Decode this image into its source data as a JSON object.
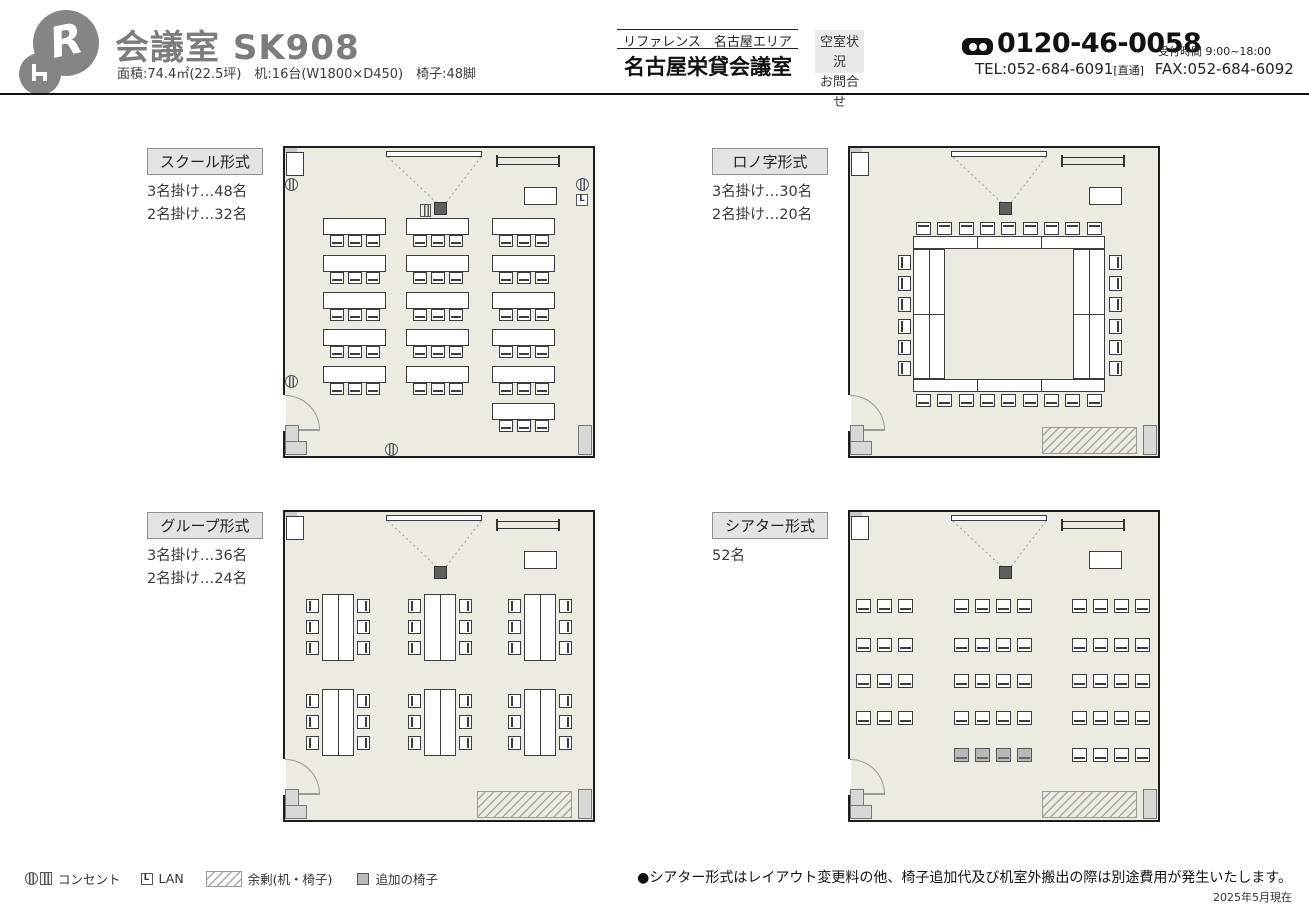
{
  "header": {
    "title": "会議室 SK908",
    "specs": "面積:74.4㎡(22.5坪)　机:16台(W1800×D450)　椅子:48脚",
    "area_line": "リファレンス　名古屋エリア",
    "venue_name": "名古屋栄貸会議室",
    "availability": [
      "空室状況",
      "お問合せ"
    ],
    "freedial": "0120-46-0058",
    "hours": "受付時間 9:00~18:00",
    "tel": "TEL:052-684-6091",
    "tel_note": "[直通]",
    "fax": "FAX:052-684-6092"
  },
  "layouts": [
    {
      "id": "school",
      "label": "スクール形式",
      "capacity": [
        "3名掛け…48名",
        "2名掛け…32名"
      ]
    },
    {
      "id": "rono",
      "label": "ロノ字形式",
      "capacity": [
        "3名掛け…30名",
        "2名掛け…20名"
      ]
    },
    {
      "id": "group",
      "label": "グループ形式",
      "capacity": [
        "3名掛け…36名",
        "2名掛け…24名"
      ]
    },
    {
      "id": "theater",
      "label": "シアター形式",
      "capacity": [
        "52名"
      ]
    }
  ],
  "legend": {
    "outlet": "コンセント",
    "lan_letter": "L",
    "lan": "LAN",
    "surplus": "余剰(机・椅子)",
    "extra_chair": "追加の椅子"
  },
  "footnote": "●シアター形式はレイアウト変更料の他、椅子追加代及び机室外搬出の際は別途費用が発生いたします。",
  "as_of": "2025年5月現在",
  "colors": {
    "room_bg": "#edeae1",
    "wall": "#1d1d1d",
    "surplus_hatch": "#a8a8a8",
    "extra_chair_fill": "#b9b9b9",
    "title_gray": "#7c7c7c"
  }
}
